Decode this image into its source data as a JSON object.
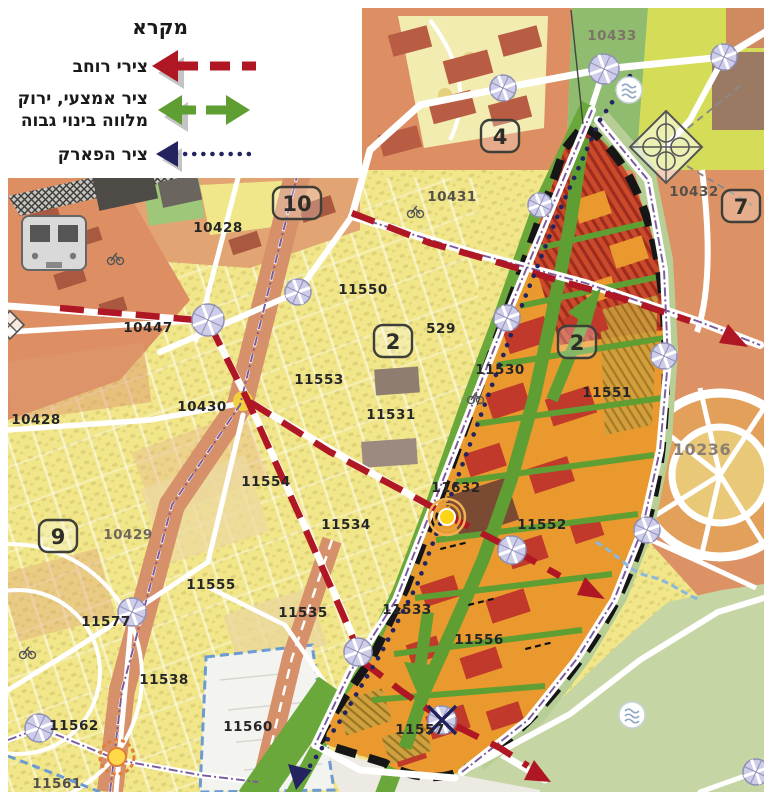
{
  "legend": {
    "title": "מקרא",
    "items": [
      {
        "id": "width-axes",
        "label": "צירי רוחב",
        "style": "red-dashed-arrow"
      },
      {
        "id": "central-green-axis",
        "label_line1": "ציר אמצעי, ירוק",
        "label_line2": "מלווה בינוי גבוה",
        "style": "green-double-arrow"
      },
      {
        "id": "park-axis",
        "label": "ציר הפארק",
        "style": "navy-dotted-arrow"
      }
    ]
  },
  "colors": {
    "width_axis_red": "#b01724",
    "green_axis": "#5f9e33",
    "park_axis_navy": "#23235f",
    "plan_boundary": "#161616",
    "plan_area_orange": "#e9992d",
    "residential_yellow": "#f1e78a",
    "urban_salmon": "#dd8f63",
    "park_green": "#c6d5a4",
    "building_red": "#c0392b",
    "roundabout_lavender": "#cdcdea",
    "zone_boundary_blue": "#6b9bd2"
  },
  "map": {
    "district_badges": [
      {
        "text": "4",
        "x": 500,
        "y": 136
      },
      {
        "text": "7",
        "x": 741,
        "y": 206
      },
      {
        "text": "10",
        "x": 297,
        "y": 203
      },
      {
        "text": "2",
        "x": 393,
        "y": 341
      },
      {
        "text": "2",
        "x": 577,
        "y": 342
      },
      {
        "text": "9",
        "x": 58,
        "y": 536
      }
    ],
    "parcel_labels": [
      {
        "text": "10433",
        "x": 612,
        "y": 40,
        "color": "#7d7468"
      },
      {
        "text": "10432",
        "x": 694,
        "y": 196,
        "color": "#55504a"
      },
      {
        "text": "10431",
        "x": 452,
        "y": 201,
        "color": "#55504a"
      },
      {
        "text": "10428",
        "x": 218,
        "y": 232
      },
      {
        "text": "11550",
        "x": 363,
        "y": 294
      },
      {
        "text": "529",
        "x": 441,
        "y": 333
      },
      {
        "text": "10447",
        "x": 148,
        "y": 332
      },
      {
        "text": "11553",
        "x": 319,
        "y": 384
      },
      {
        "text": "11531",
        "x": 391,
        "y": 419
      },
      {
        "text": "10430",
        "x": 202,
        "y": 411
      },
      {
        "text": "10428",
        "x": 36,
        "y": 424
      },
      {
        "text": "11530",
        "x": 500,
        "y": 374
      },
      {
        "text": "11551",
        "x": 607,
        "y": 397
      },
      {
        "text": "10236",
        "x": 702,
        "y": 455,
        "color": "#8a7f72",
        "size": 16
      },
      {
        "text": "11554",
        "x": 266,
        "y": 486
      },
      {
        "text": "11632",
        "x": 456,
        "y": 492
      },
      {
        "text": "11534",
        "x": 346,
        "y": 529
      },
      {
        "text": "10429",
        "x": 128,
        "y": 539,
        "color": "#6f675d"
      },
      {
        "text": "11552",
        "x": 542,
        "y": 529
      },
      {
        "text": "11555",
        "x": 211,
        "y": 589
      },
      {
        "text": "11535",
        "x": 303,
        "y": 617
      },
      {
        "text": "11577",
        "x": 106,
        "y": 626
      },
      {
        "text": "11533",
        "x": 407,
        "y": 614
      },
      {
        "text": "11556",
        "x": 479,
        "y": 644
      },
      {
        "text": "11538",
        "x": 164,
        "y": 684
      },
      {
        "text": "11562",
        "x": 74,
        "y": 730
      },
      {
        "text": "11560",
        "x": 248,
        "y": 731
      },
      {
        "text": "11557",
        "x": 420,
        "y": 734
      },
      {
        "text": "11561",
        "x": 57,
        "y": 788,
        "color": "#55504a"
      }
    ]
  }
}
